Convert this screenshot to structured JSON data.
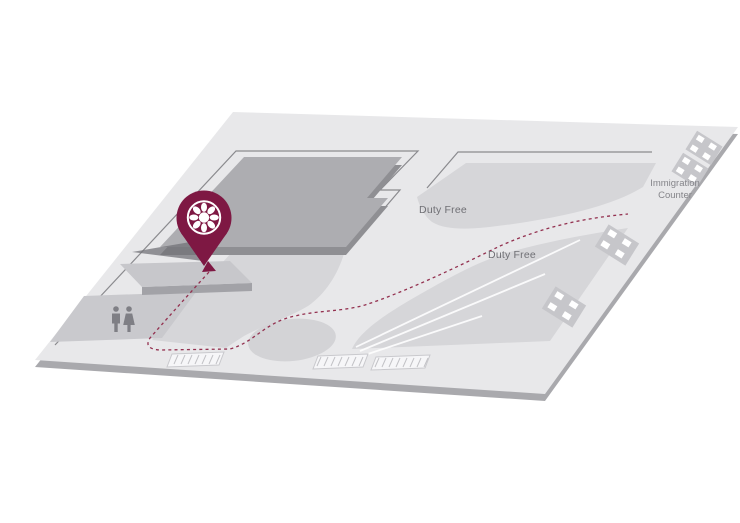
{
  "map": {
    "labels": {
      "duty_free_upper": "Duty Free",
      "duty_free_lower": "Duty Free",
      "immigration_line1": "Immigration",
      "immigration_line2": "Counter"
    },
    "colors": {
      "background": "#FFFFFF",
      "floor": "#E8E8EA",
      "floor_side": "#A9A9AD",
      "zone": "#D6D6D9",
      "zone_dark": "#D3D3D6",
      "block_top": "#ADADB1",
      "block_side": "#8F8F93",
      "ledge_top": "#C7C7CB",
      "ledge_side": "#A2A2A7",
      "restroom_zone": "#C9C9CD",
      "counter": "#C6C6CA",
      "icon_gray": "#7F7F85",
      "outline": "#8A8A8E",
      "accent": "#7E1843",
      "route": "#93304F",
      "label_text": "#6F6F74",
      "label_text_light": "#85858A"
    },
    "icons": {
      "pin": "location-pin",
      "logo": "rosette-logo",
      "restrooms": "restroom-men-women-icon",
      "arrow": "route-arrow-icon"
    }
  }
}
